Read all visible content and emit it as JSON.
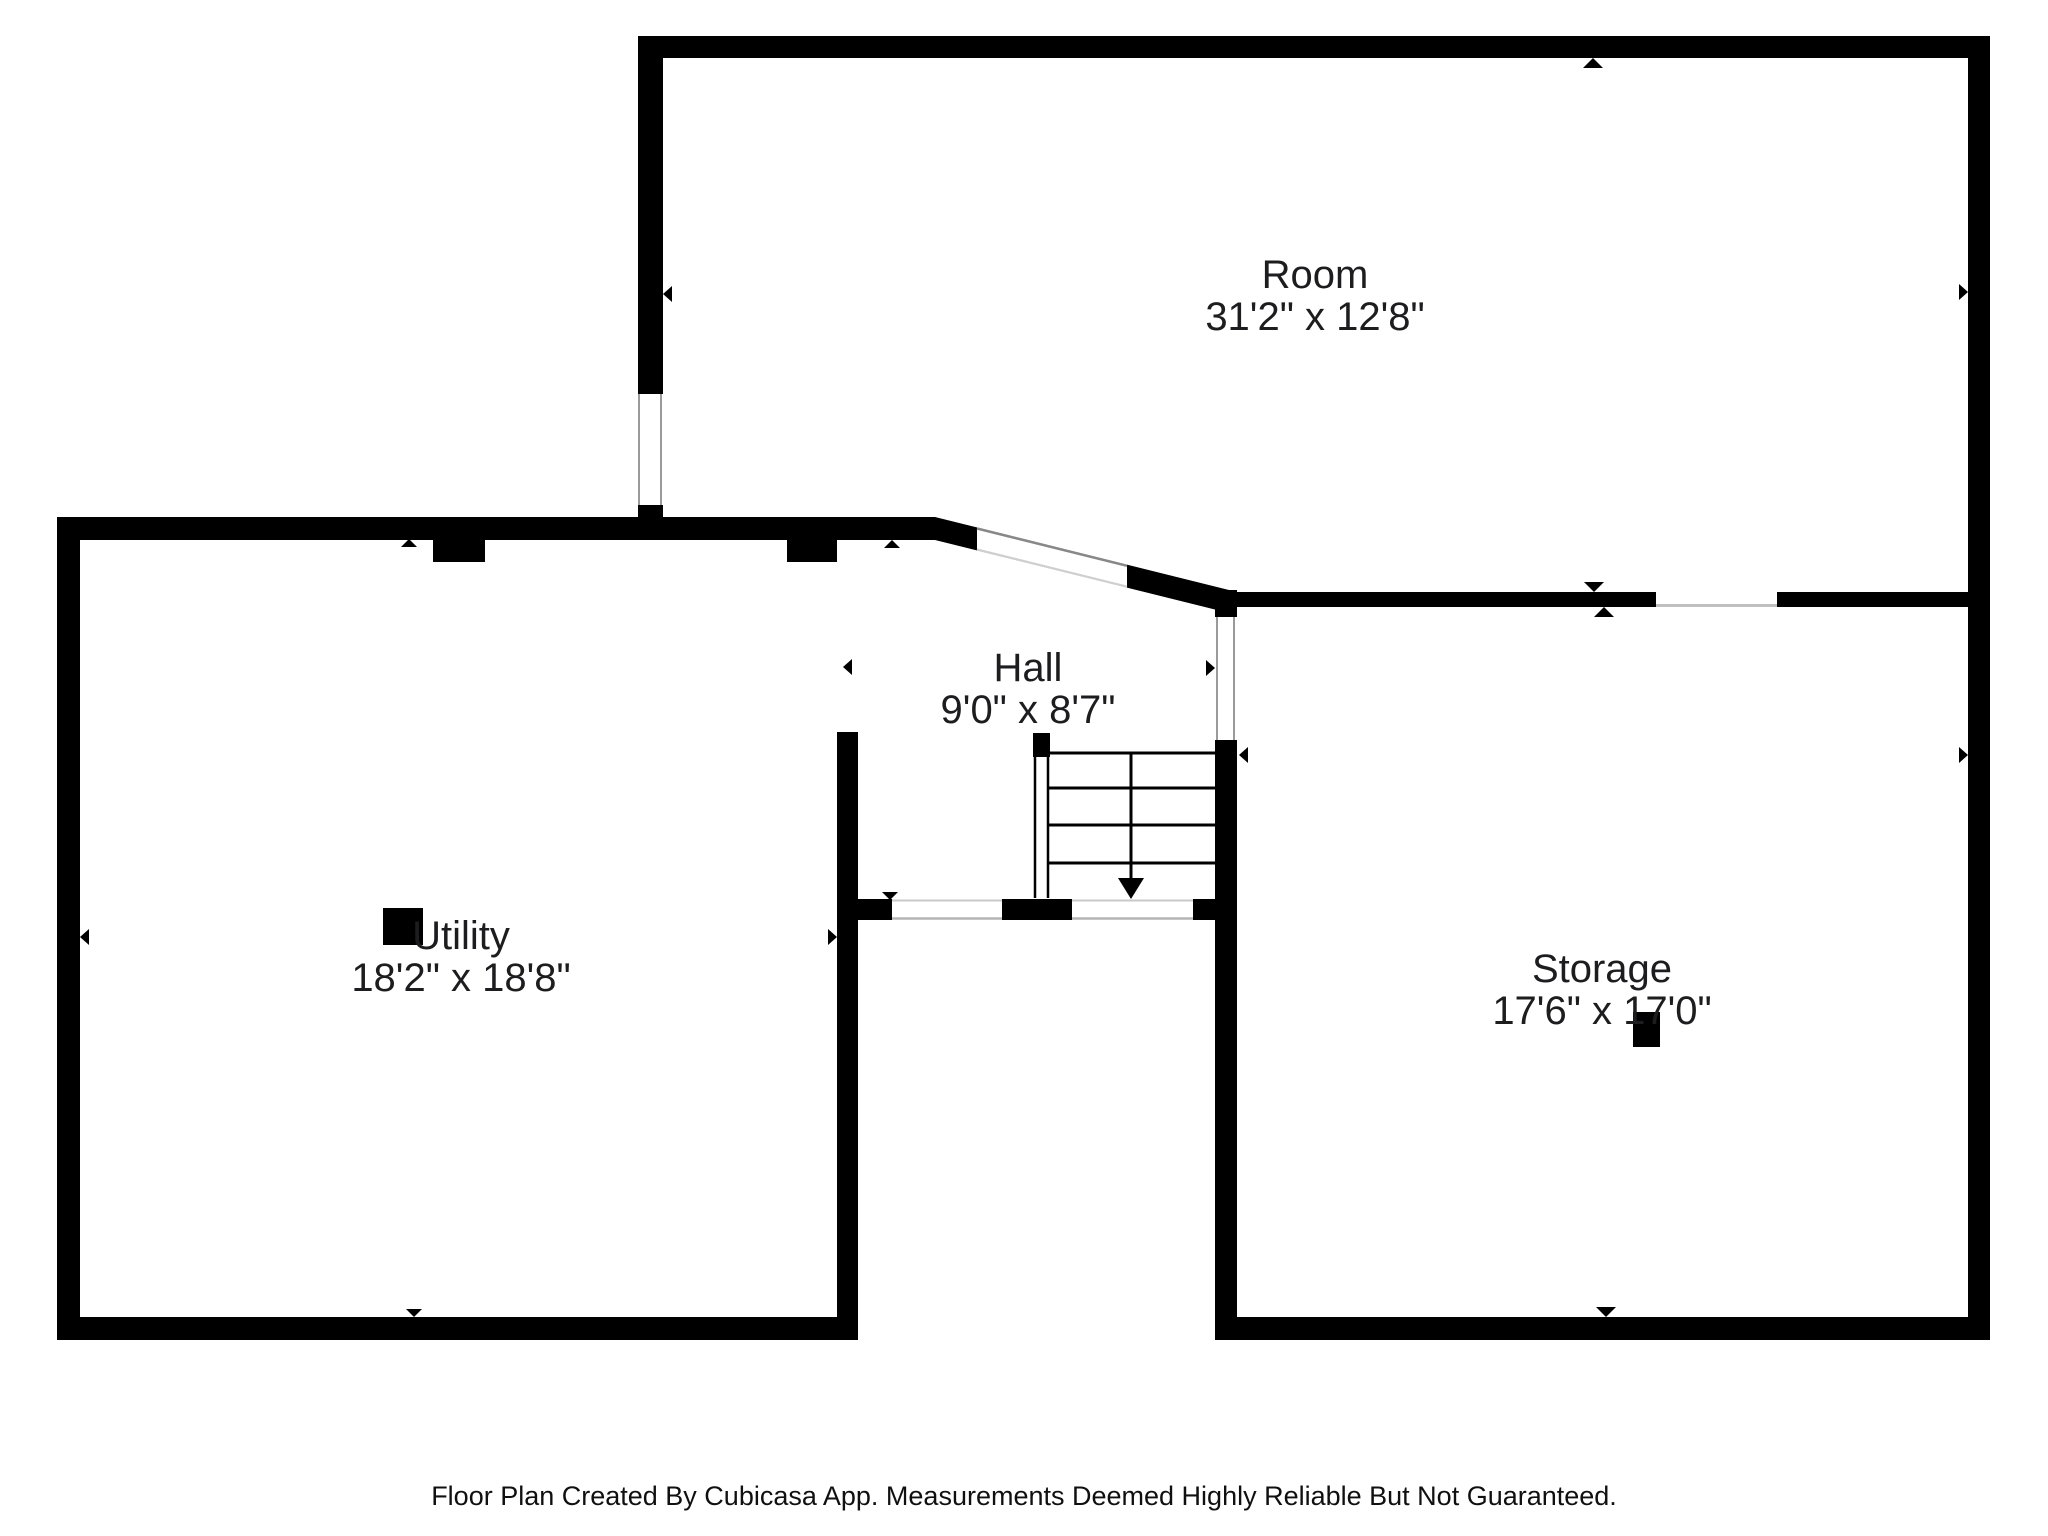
{
  "floorplan": {
    "rooms": [
      {
        "id": "room",
        "name": "Room",
        "dimensions": "31'2\" x 12'8\""
      },
      {
        "id": "hall",
        "name": "Hall",
        "dimensions": "9'0\" x 8'7\""
      },
      {
        "id": "utility",
        "name": "Utility",
        "dimensions": "18'2\" x 18'8\""
      },
      {
        "id": "storage",
        "name": "Storage",
        "dimensions": "17'6\" x 17'0\""
      }
    ],
    "colors": {
      "wall": "#000000",
      "background": "#ffffff",
      "label_text": "#1d1d1f",
      "window_line": "#9a9a9a",
      "opening_line": "#c8c8c8"
    },
    "footer": "Floor Plan Created By Cubicasa App. Measurements Deemed Highly Reliable But Not Guaranteed."
  }
}
